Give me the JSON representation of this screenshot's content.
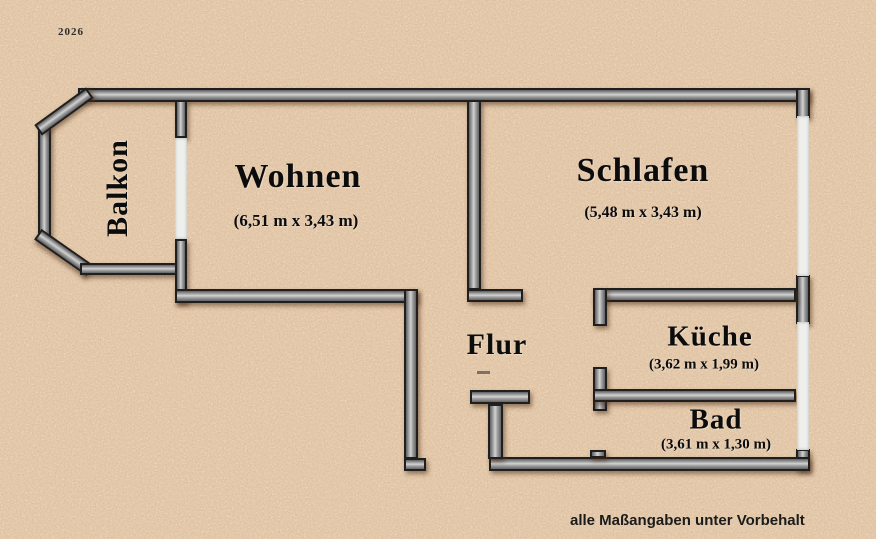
{
  "plan": {
    "number": "2026",
    "disclaimer": "alle Maßangaben unter Vorbehalt"
  },
  "rooms": {
    "balkon": {
      "name": "Balkon"
    },
    "wohnen": {
      "name": "Wohnen",
      "dims": "(6,51 m x 3,43 m)"
    },
    "schlafen": {
      "name": "Schlafen",
      "dims": "(5,48 m x 3,43 m)"
    },
    "flur": {
      "name": "Flur"
    },
    "kueche": {
      "name": "Küche",
      "dims": "(3,62 m x 1,99 m)"
    },
    "bad": {
      "name": "Bad",
      "dims": "(3,61 m x 1,30 m)"
    }
  },
  "colors": {
    "background": "#dfc0a0",
    "wall_fill": "#a8a8a8",
    "wall_outline": "#1f1f1f",
    "opening": "#efefed",
    "text": "#0c0c0c"
  }
}
